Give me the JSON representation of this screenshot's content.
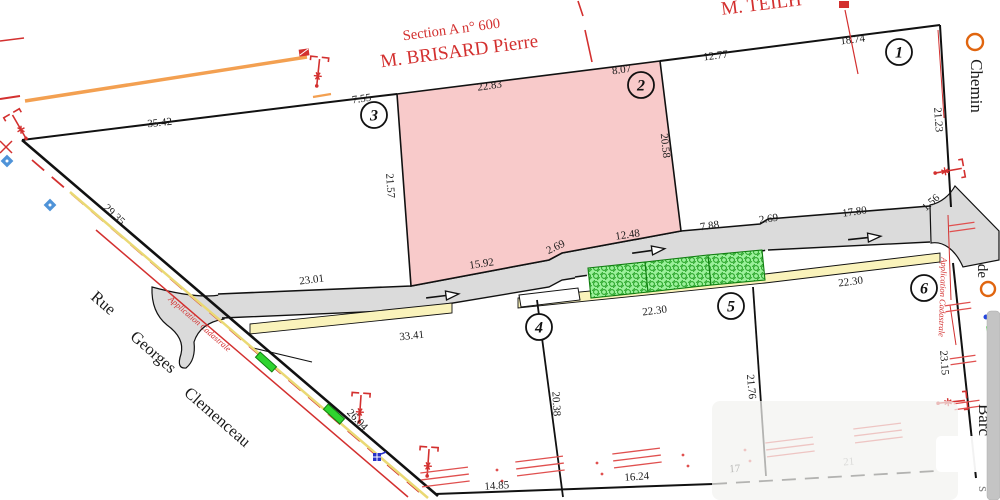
{
  "colors": {
    "pink": "#f8caca",
    "road": "#dbdbdb",
    "yellow": "#faf3bb",
    "green": "#9bf09b",
    "green_dark": "#1f9e1f",
    "red": "#d3302f",
    "orange_line": "#f3a051",
    "scrollbar": "#c4c4c4"
  },
  "labels": {
    "section": "Section A n° 600",
    "owner_top": "M. BRISARD Pierre",
    "owner_top_right": "M. TEILH",
    "street_left_1": "Rue",
    "street_left_2": "Georges",
    "street_left_3": "Clemenceau",
    "street_right_1": "Chemin",
    "street_right_2": "de",
    "street_right_3": "Barc",
    "street_right_4": "s",
    "app_cadastrale_left": "Application Cadastrale",
    "app_cadastrale_right": "Application Cadastrale"
  },
  "parcels": [
    "1",
    "2",
    "3",
    "4",
    "5",
    "6"
  ],
  "measurements": [
    "35.42",
    "29.35",
    "7.55",
    "22.83",
    "8.07",
    "12.77",
    "18.74",
    "21.23",
    "20.58",
    "21.57",
    "23.01",
    "15.92",
    "2.69",
    "12.48",
    "7.88",
    "2.69",
    "17.80",
    "1.56",
    "22.30",
    "22.30",
    "33.41",
    "26.04",
    "20.38",
    "21.76",
    "23.15",
    "14.85",
    "16.24",
    "17",
    "21"
  ]
}
